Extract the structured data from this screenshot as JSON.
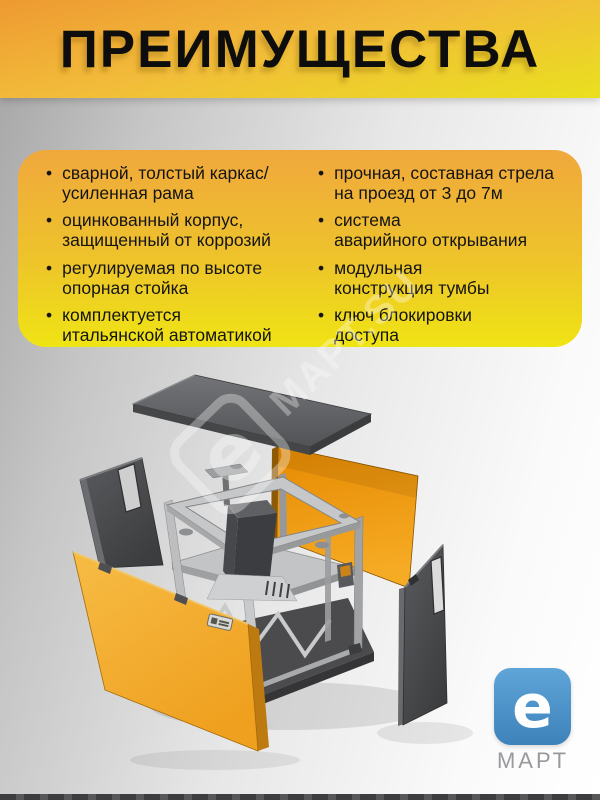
{
  "title": "ПРЕИМУЩЕСТВА",
  "advantages": {
    "left": [
      "сварной, толстый каркас/\nусиленная рама",
      "оцинкованный корпус,\nзащищенный от коррозий",
      "регулируемая по высоте\nопорная стойка",
      "комплектуется\nитальянской автоматикой"
    ],
    "right": [
      "прочная, составная стрела\nна проезд от 3 до 7м",
      "система\nаварийного открывания",
      "модульная\nконструкция тумбы",
      "ключ блокировки\nдоступа"
    ]
  },
  "bullet_glyph": "•",
  "watermark": {
    "letter": "e",
    "text": "МАРТ.SU"
  },
  "logo": {
    "letter": "e",
    "caption": "МАРТ"
  },
  "colors": {
    "band_orange": "#EE9A31",
    "band_yellow": "#E9E01E",
    "panel_top_orange": "#F0A83D",
    "panel_bottom_yellow": "#EFE414",
    "cabinet_orange": "#F2A92E",
    "cabinet_dark_gray": "#4A4B4E",
    "logo_blue": "#4590C8"
  }
}
